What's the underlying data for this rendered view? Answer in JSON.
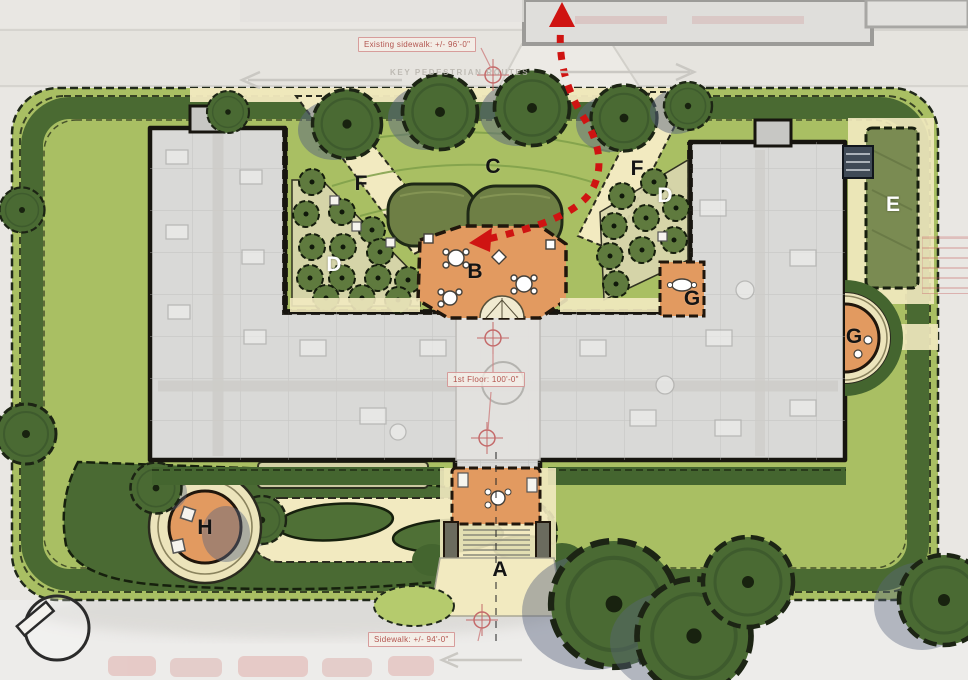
{
  "plan": {
    "annotations": {
      "existing_sidewalk": "Existing sidewalk:  +/- 96'-0\"",
      "first_floor": "1st Floor: 100'-0\"",
      "sidewalk": "Sidewalk:  +/- 94'-0\"",
      "key_pedestrian_routes": "KEY PEDESTRIAN ROUTES"
    },
    "area_labels": [
      {
        "id": "A",
        "text": "A"
      },
      {
        "id": "B",
        "text": "B"
      },
      {
        "id": "C",
        "text": "C"
      },
      {
        "id": "D-left",
        "text": "D"
      },
      {
        "id": "D-right",
        "text": "D"
      },
      {
        "id": "E",
        "text": "E"
      },
      {
        "id": "F-left",
        "text": "F"
      },
      {
        "id": "F-right",
        "text": "F"
      },
      {
        "id": "G-inner",
        "text": "G"
      },
      {
        "id": "G-right",
        "text": "G"
      },
      {
        "id": "H",
        "text": "H"
      }
    ],
    "colors": {
      "lawn": "#a9bf63",
      "hedge_dark": "#44652f",
      "building_gray": "#d9d9d7",
      "patio_orange": "#e29a60",
      "path_yellow": "#f2eac0",
      "route_red": "#cf1412",
      "annotation_red": "#b2544e",
      "tree_green": "#4a6a33",
      "shadow_blue": "#5a6680"
    }
  }
}
